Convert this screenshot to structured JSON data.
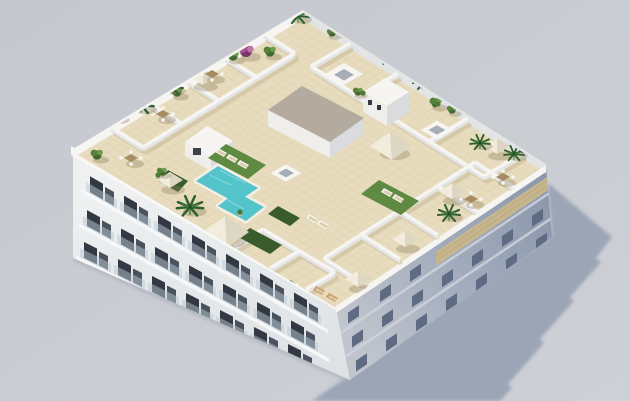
{
  "scene": {
    "type": "3d-architectural-render",
    "view": "aerial-isometric",
    "description": "New-build white apartment block with communal rooftop terrace: L-shaped turquoise pool, artificial lawns with sun loungers, white pergolas and parasols, palm trees, shrubs and bougainvillea, private roof terraces divided by white walls, glass balconies on the street facade, shaded blue-grey side facade with wooden lattice balconies, long cast shadow on a plain grey studio backdrop",
    "floors_visible": 4,
    "objects": [
      "apartment-building",
      "rooftop-terrace",
      "swimming-pool",
      "lawn",
      "sun-loungers",
      "parasols",
      "pergolas",
      "pool-house",
      "stair-core",
      "penthouse-volume",
      "skylights",
      "palm-trees",
      "shrubs",
      "bougainvillea",
      "potted-plants",
      "dining-sets",
      "private-terraces",
      "divider-walls",
      "balconies",
      "lattice-balcony",
      "cast-shadow"
    ]
  },
  "colors": {
    "bg": "#c5c8ce",
    "bg2": "#cdd0d5",
    "shadow": "#99a2b4",
    "deck": "#e8dcbe",
    "tile": "#d7c9a8",
    "wallTop": "#f6f5f1",
    "wallFace": "#e3e4e6",
    "wallShadow": "#c3b694",
    "facadeSw": "#eef0f1",
    "facadeSwDark": "#dde1e4",
    "cornice": "#f8f8f6",
    "window": "#333942",
    "glass": "#b9c9d3",
    "facadeSeLight": "#c0c4cc",
    "facadeSeDark": "#8a95ab",
    "seWindow": "#5e6b83",
    "lattice": "#c6b68e",
    "pool": "#54c4cb",
    "poolLight": "#8adde0",
    "lawn": "#5f8a41",
    "hedge": "#3a5c2c",
    "canopy": "#f1ecdc",
    "canopyShade": "#ddd6c2",
    "coreRoof": "#b3ab9f",
    "palm": "#2f6030",
    "bush": "#57813a",
    "bushDark": "#44682f",
    "bushLight": "#6b9a49",
    "bougainvillea": "#a85590",
    "tanWood": "#c49b62",
    "tableWood": "#a78c63"
  }
}
